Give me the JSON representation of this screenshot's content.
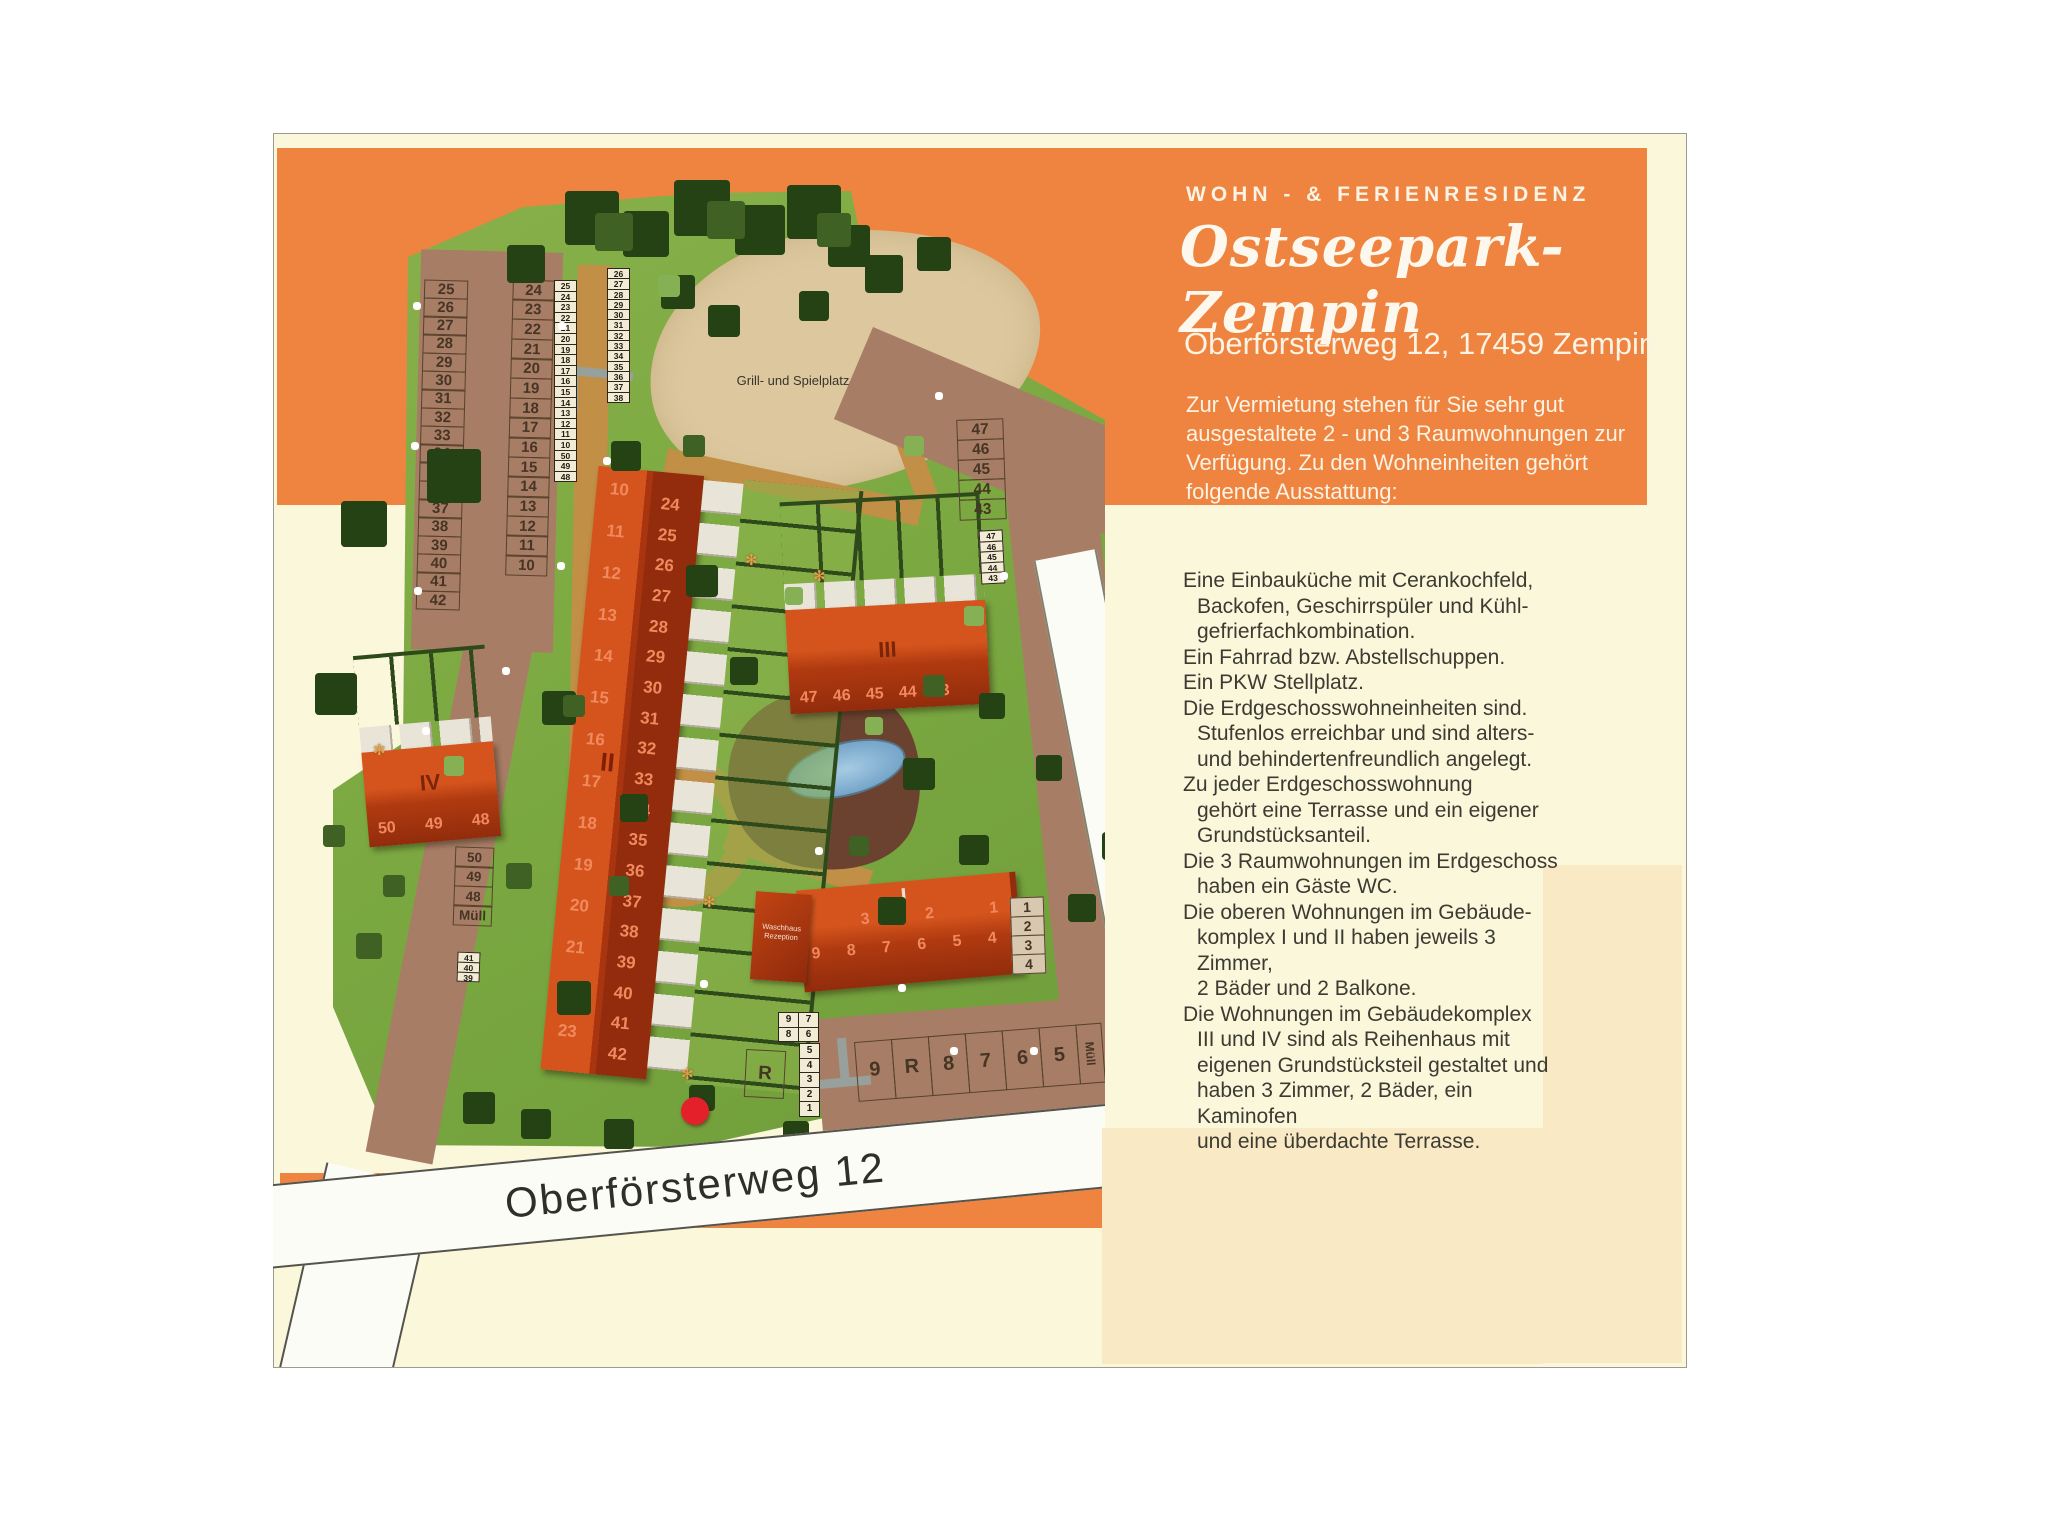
{
  "header": {
    "kicker": "WOHN - & FERIENRESIDENZ",
    "title": "Ostseepark-Zempin",
    "address": "Oberförsterweg 12, 17459 Zempin",
    "intro": "Zur Vermietung stehen für Sie sehr gut\nausgestaltete 2 - und 3 Raumwohnungen zur\nVerfügung. Zu den Wohneinheiten gehört\nfolgende Ausstattung:"
  },
  "features": [
    "Eine Einbauküche mit Cerankochfeld,\nBackofen, Geschirrspüler und Kühl-\ngefrierfachkombination.",
    "Ein Fahrrad bzw. Abstellschuppen.",
    "Ein PKW Stellplatz.",
    "Die Erdgeschosswohneinheiten sind.\nStufenlos erreichbar und sind alters-\nund behindertenfreundlich angelegt.",
    "Zu jeder Erdgeschosswohnung\ngehört eine Terrasse und ein eigener\nGrundstücksanteil.",
    "Die 3 Raumwohnungen im Erdgeschoss\nhaben ein Gäste WC.",
    "Die oberen Wohnungen im Gebäude-\nkomplex I und II haben jeweils 3 Zimmer,\n2 Bäder und 2 Balkone.",
    "Die Wohnungen im Gebäudekomplex\nIII und IV sind als Reihenhaus mit\neigenen Grundstücksteil gestaltet und\nhaben 3 Zimmer, 2 Bäder, ein Kaminofen\nund eine überdachte Terrasse."
  ],
  "map": {
    "playground_label": "Grill- und Spielplatz",
    "street_label": "Oberförsterweg 12",
    "waschhaus_label": "Waschhaus Rezeption",
    "flower_icon": "✻",
    "buildings": {
      "I": {
        "label": "I",
        "row_upper": [
          "3",
          "2",
          "1"
        ],
        "row_lower": [
          "9",
          "8",
          "7",
          "6",
          "5",
          "4"
        ]
      },
      "II": {
        "label": "II",
        "left_units": [
          "10",
          "11",
          "12",
          "13",
          "14",
          "15",
          "16",
          "17",
          "18",
          "19",
          "20",
          "21",
          "22",
          "23"
        ],
        "right_units": [
          "24",
          "25",
          "26",
          "27",
          "28",
          "29",
          "30",
          "31",
          "32",
          "33",
          "34",
          "35",
          "36",
          "37",
          "38",
          "39",
          "40",
          "41",
          "42"
        ]
      },
      "III": {
        "label": "III",
        "units": [
          "47",
          "46",
          "45",
          "44",
          "43"
        ]
      },
      "IV": {
        "label": "IV",
        "units": [
          "50",
          "49",
          "48"
        ]
      }
    },
    "parking": {
      "nw_left": [
        "25",
        "26",
        "27",
        "28",
        "29",
        "30",
        "31",
        "32",
        "33",
        "34",
        "35",
        "36",
        "37",
        "38",
        "39",
        "40",
        "41",
        "42"
      ],
      "nw_right": [
        "24",
        "23",
        "22",
        "21",
        "20",
        "19",
        "18",
        "17",
        "16",
        "15",
        "14",
        "13",
        "12",
        "11",
        "10"
      ],
      "ne": [
        "47",
        "46",
        "45",
        "44",
        "43"
      ],
      "sw": [
        "50",
        "49",
        "48",
        "Müll"
      ],
      "east": [
        "1",
        "2",
        "3",
        "4"
      ],
      "south_row": [
        "9",
        "R",
        "8",
        "7",
        "6",
        "5"
      ],
      "south_muell": "Müll",
      "r_single": "R",
      "mini_rows": [
        [
          "9",
          "7"
        ],
        [
          "8",
          "6"
        ]
      ],
      "mini_tail": [
        "5",
        "4",
        "3",
        "2",
        "1"
      ]
    },
    "sheds": {
      "col_a": [
        "25",
        "24",
        "23",
        "22",
        "21",
        "20",
        "19",
        "18",
        "17",
        "16",
        "15",
        "14",
        "13",
        "12",
        "11",
        "10",
        "50",
        "49",
        "48"
      ],
      "col_b": [
        "26",
        "27",
        "28",
        "29",
        "30",
        "31",
        "32",
        "33",
        "34",
        "35",
        "36",
        "37",
        "38"
      ],
      "col_ne": [
        "47",
        "46",
        "45",
        "44",
        "43"
      ],
      "col_sw": [
        "41",
        "40",
        "39"
      ]
    }
  },
  "colors": {
    "orange": "#ee8440",
    "cream": "#faf7da",
    "peach": "#f9e9c5",
    "grass_a": "#8ab14c",
    "grass_b": "#6f9d3a",
    "sand": "#dcc79e",
    "road_brown": "#a87d66",
    "path_tan": "#c18f45",
    "building_red": "#c74514",
    "roof_dark": "#922c0c",
    "roof_light": "#d5541d",
    "unit_number": "#f08a5e",
    "stall_line": "#57422c",
    "stall_text": "#463525",
    "shed_bg": "#f2ecd7",
    "white_road": "#fcfcf7",
    "red_dot": "#e4212a",
    "hedge": "#2e4a1b",
    "terrace": "#e9e4d8",
    "text_dark": "#3c3b33",
    "text_light": "#fbf3e3",
    "label_dark": "#7a2408"
  }
}
